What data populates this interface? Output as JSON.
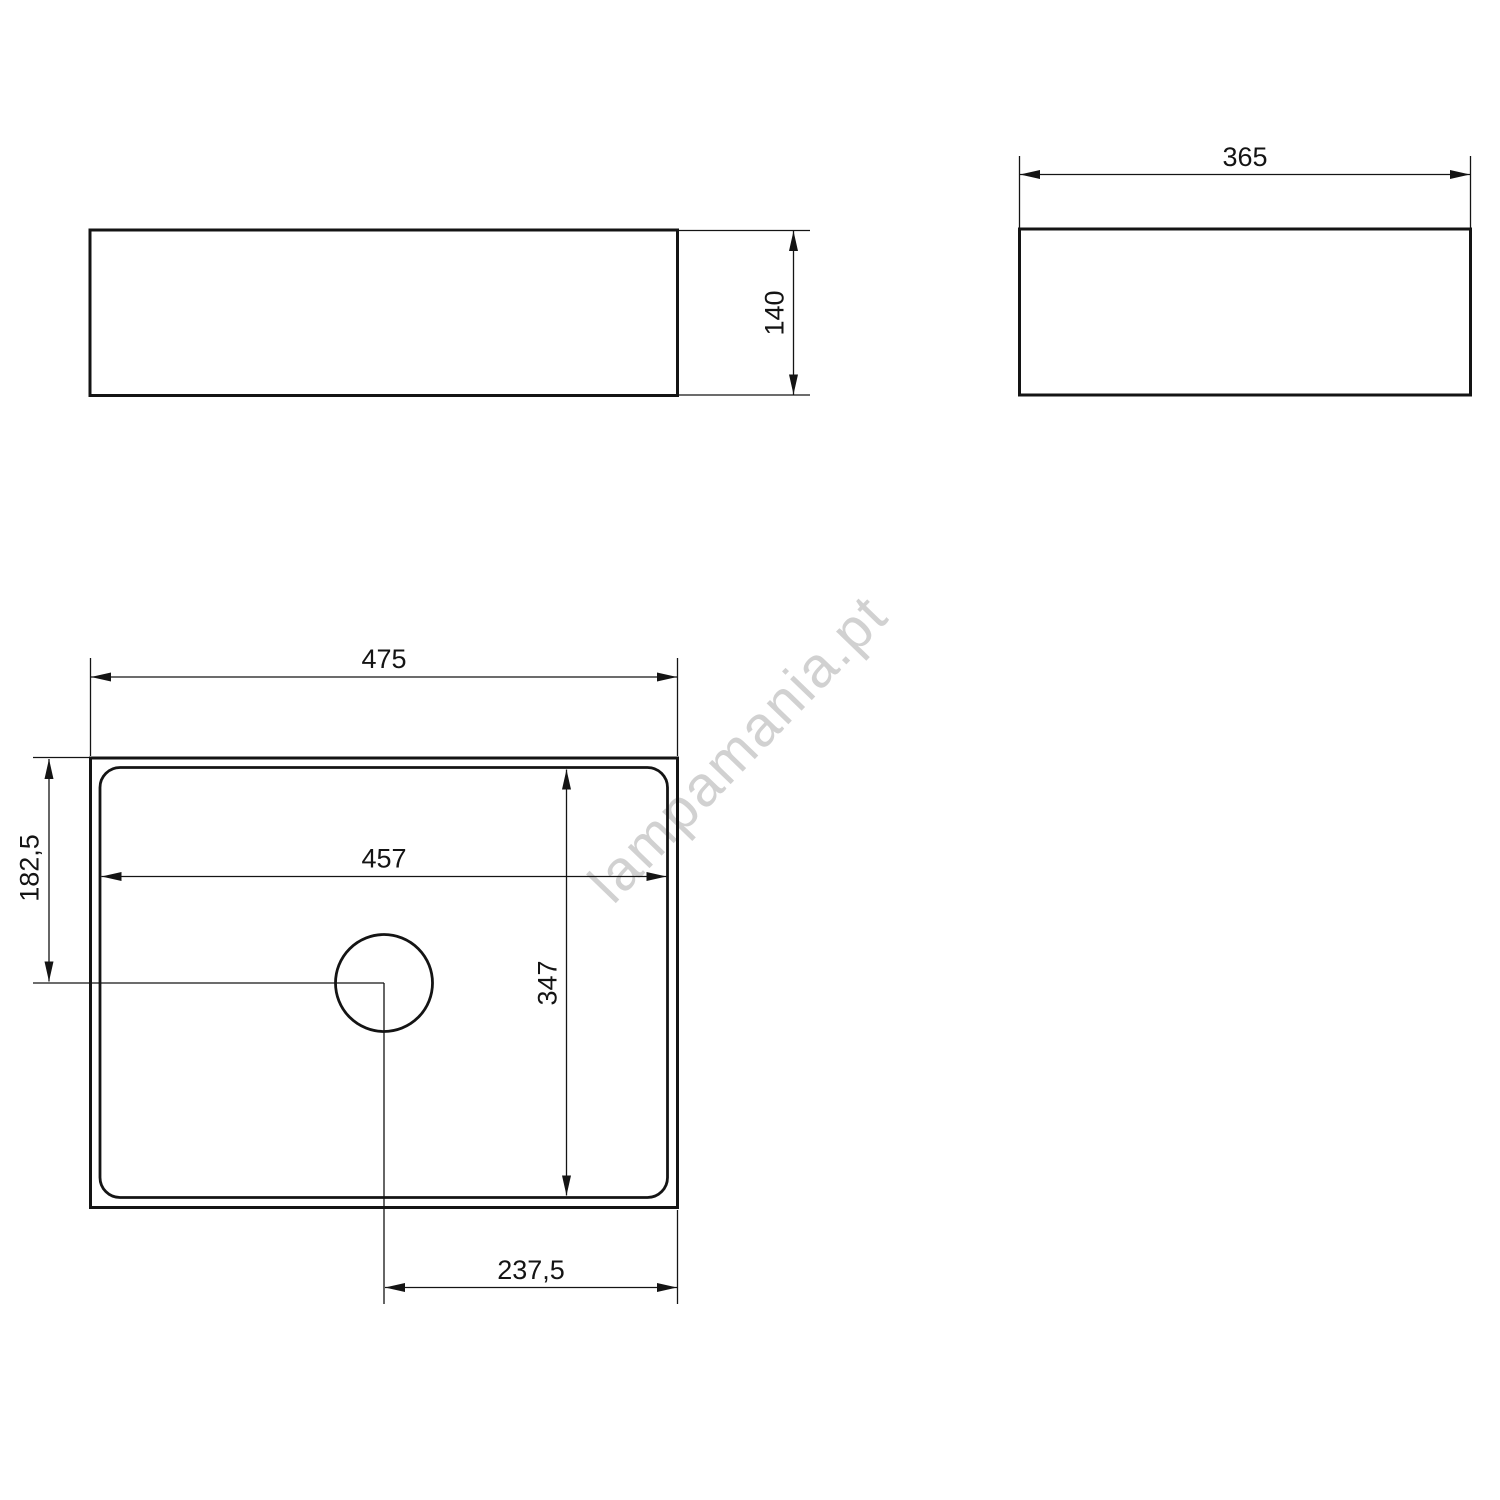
{
  "drawing": {
    "type": "technical-dimension-drawing",
    "subject": "rectangular countertop washbasin with drain hole",
    "watermark": "lampamania.pt",
    "colors": {
      "line": "#141414",
      "background": "#ffffff",
      "watermark": "#d1d1d1"
    },
    "views": {
      "front": {
        "name": "front-view",
        "dimensions": {
          "height": "140"
        }
      },
      "side": {
        "name": "side-view",
        "dimensions": {
          "width": "365"
        }
      },
      "plan": {
        "name": "plan-view",
        "dimensions": {
          "outer_width": "475",
          "inner_width": "457",
          "drain_center_from_top": "182,5",
          "inner_depth": "347",
          "drain_center_from_right": "237,5"
        }
      }
    }
  }
}
